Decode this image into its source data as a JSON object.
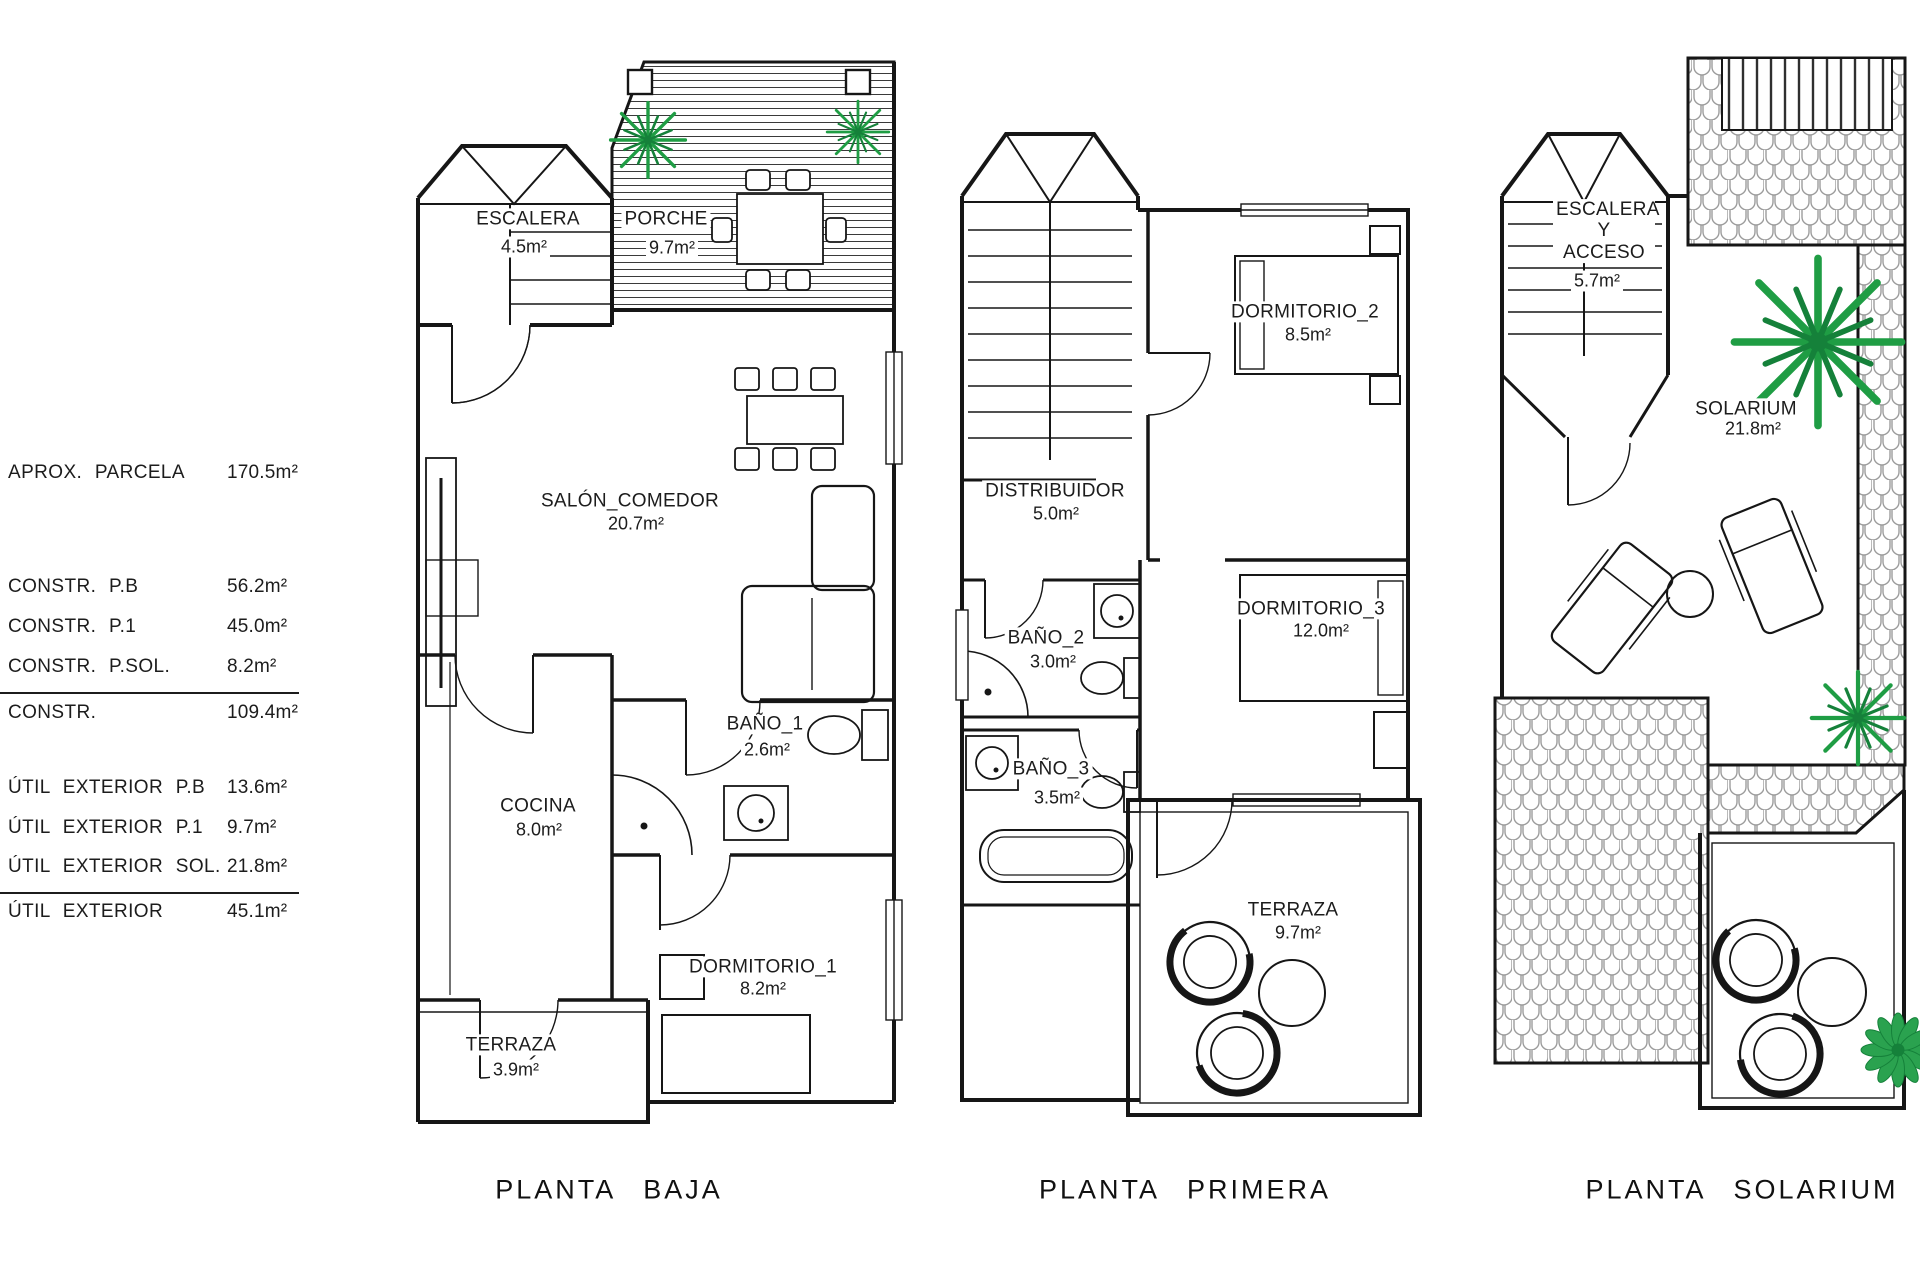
{
  "legend": {
    "rows": [
      {
        "label": "APROX. PARCELA",
        "value": "170.5m²"
      },
      {
        "label": "CONSTR. P.B",
        "value": "56.2m²"
      },
      {
        "label": "CONSTR. P.1",
        "value": "45.0m²"
      },
      {
        "label": "CONSTR. P.SOL.",
        "value": "8.2m²"
      },
      {
        "label": "CONSTR.",
        "value": "109.4m²"
      },
      {
        "label": "ÚTIL EXTERIOR P.B",
        "value": "13.6m²"
      },
      {
        "label": "ÚTIL EXTERIOR P.1",
        "value": "9.7m²"
      },
      {
        "label": "ÚTIL EXTERIOR SOL.",
        "value": "21.8m²"
      },
      {
        "label": "ÚTIL EXTERIOR",
        "value": "45.1m²"
      }
    ]
  },
  "plans": [
    {
      "title": "PLANTA BAJA",
      "rooms": [
        {
          "name": "ESCALERA",
          "area": "4.5m²"
        },
        {
          "name": "PORCHE",
          "area": "9.7m²"
        },
        {
          "name": "SALÓN_COMEDOR",
          "area": "20.7m²"
        },
        {
          "name": "COCINA",
          "area": "8.0m²"
        },
        {
          "name": "BAÑO_1",
          "area": "2.6m²"
        },
        {
          "name": "DORMITORIO_1",
          "area": "8.2m²"
        },
        {
          "name": "TERRAZA",
          "area": "3.9m²"
        }
      ]
    },
    {
      "title": "PLANTA PRIMERA",
      "rooms": [
        {
          "name": "DORMITORIO_2",
          "area": "8.5m²"
        },
        {
          "name": "DISTRIBUIDOR",
          "area": "5.0m²"
        },
        {
          "name": "BAÑO_2",
          "area": "3.0m²"
        },
        {
          "name": "DORMITORIO_3",
          "area": "12.0m²"
        },
        {
          "name": "BAÑO_3",
          "area": "3.5m²"
        },
        {
          "name": "TERRAZA",
          "area": "9.7m²"
        }
      ]
    },
    {
      "title": "PLANTA SOLARIUM",
      "rooms": [
        {
          "name": "ESCALERA Y ACCESO",
          "area": "5.7m²"
        },
        {
          "name": "SOLARIUM",
          "area": "21.8m²"
        }
      ]
    }
  ],
  "colors": {
    "line": "#161616",
    "plant_green": "#1f9d44",
    "plant_green_dark": "#15813a",
    "tile_gray": "#9c9c9c"
  }
}
